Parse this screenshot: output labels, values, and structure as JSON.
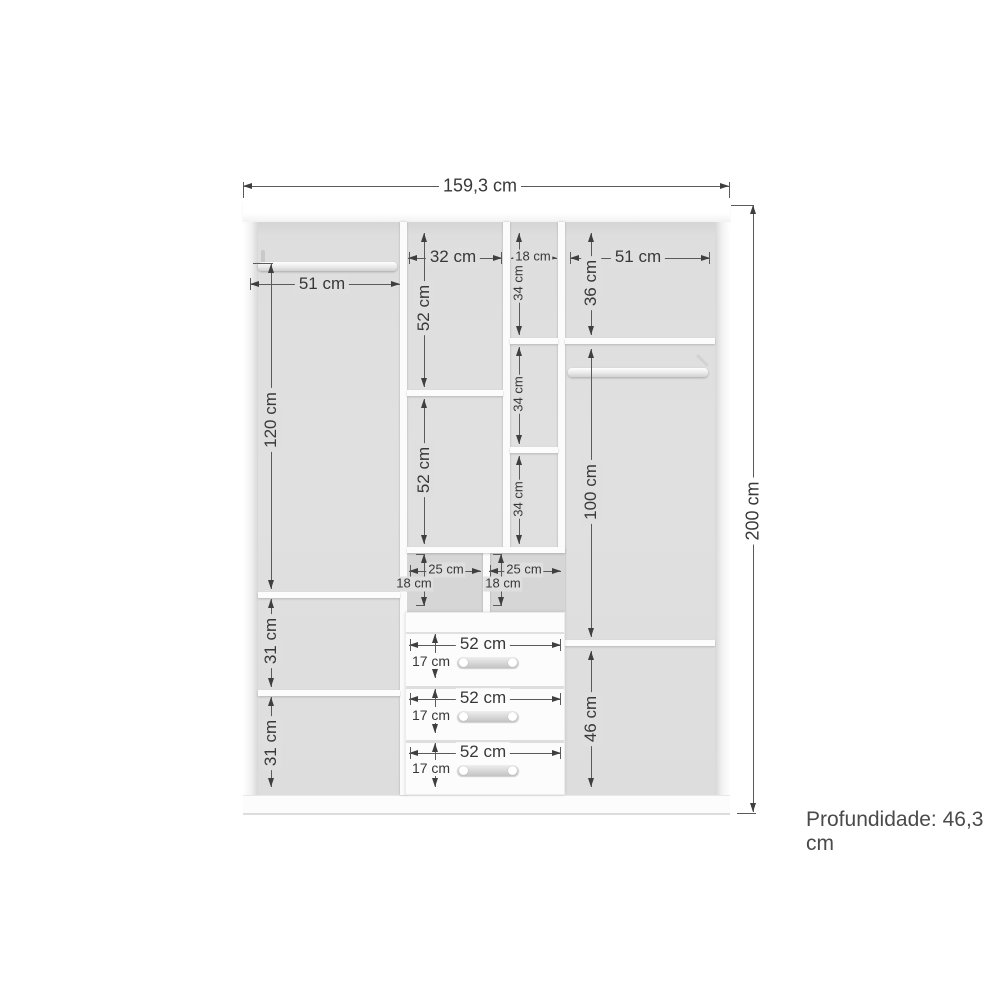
{
  "overall": {
    "width_label": "159,3 cm",
    "height_label": "200 cm",
    "depth_label": "Profundidade: 46,3 cm"
  },
  "left_section": {
    "rod_width": "51 cm",
    "upper_height": "120 cm",
    "shelf_gap_1": "31 cm",
    "shelf_gap_2": "31 cm"
  },
  "middle_section": {
    "width": "32 cm",
    "upper_height": "52 cm",
    "lower_height": "52 cm"
  },
  "narrow_section": {
    "width": "18 cm",
    "gap_1": "34 cm",
    "gap_2": "34 cm",
    "gap_3": "34 cm"
  },
  "right_section": {
    "width": "51 cm",
    "top_height": "36 cm",
    "middle_height": "100 cm",
    "bottom_height": "46 cm"
  },
  "cubbies": {
    "left": {
      "width": "25 cm",
      "height": "18 cm"
    },
    "right": {
      "width": "25 cm",
      "height": "18 cm"
    }
  },
  "drawers": [
    {
      "width": "52 cm",
      "height": "17 cm"
    },
    {
      "width": "52 cm",
      "height": "17 cm"
    },
    {
      "width": "52 cm",
      "height": "17 cm"
    }
  ],
  "colors": {
    "dimension_line": "#5a5a5a",
    "dimension_text": "#383838",
    "interior_gray": "#dfdfdf",
    "panel_white": "#fbfbfb"
  }
}
